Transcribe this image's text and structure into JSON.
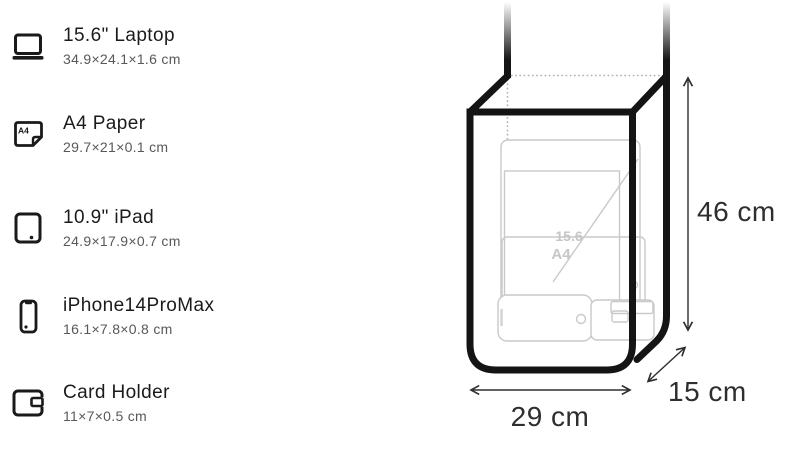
{
  "page": {
    "background": "#ffffff",
    "outline_color": "#141414",
    "ghost_color": "#c9c9c9",
    "dimension_color": "#2e2e2e"
  },
  "items": [
    {
      "icon": "laptop-icon",
      "title": "15.6\" Laptop",
      "dims": "34.9×24.1×1.6 cm"
    },
    {
      "icon": "a4-paper-icon",
      "title": "A4 Paper",
      "dims": "29.7×21×0.1 cm",
      "icon_label": "A4"
    },
    {
      "icon": "ipad-icon",
      "title": "10.9\" iPad",
      "dims": "24.9×17.9×0.7 cm"
    },
    {
      "icon": "iphone-icon",
      "title": "iPhone14ProMax",
      "dims": "16.1×7.8×0.8 cm"
    },
    {
      "icon": "card-holder-icon",
      "title": "Card Holder",
      "dims": "11×7×0.5 cm"
    }
  ],
  "diagram": {
    "height_label": "46 cm",
    "width_label": "29 cm",
    "depth_label": "15 cm",
    "inner_labels": {
      "laptop_diagonal": "15.6",
      "a4_sheet": "A4"
    }
  }
}
